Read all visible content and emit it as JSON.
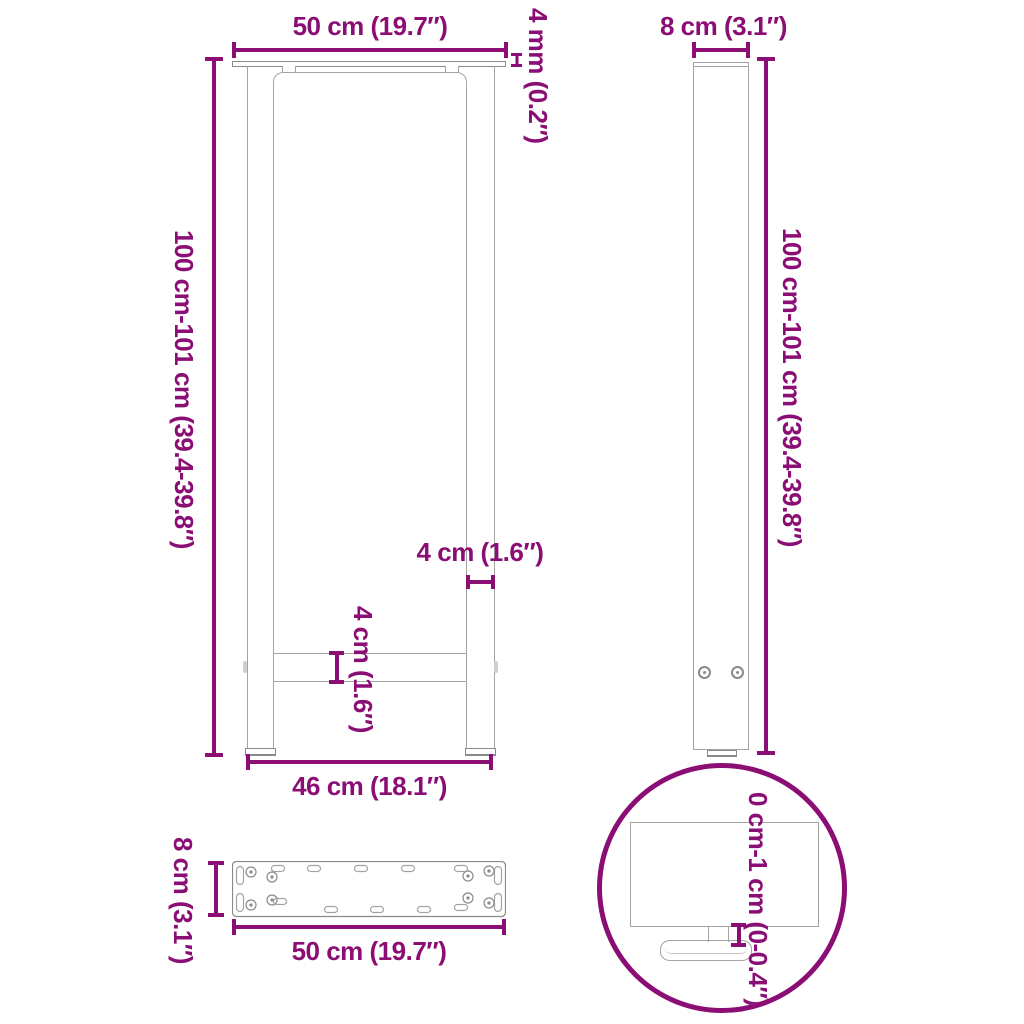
{
  "colors": {
    "accent": "#8A0E74",
    "line_gray": "#A3A3A3",
    "dark_gray": "#8A8A8A",
    "background": "#FFFFFF"
  },
  "front_view": {
    "top_width": "50 cm (19.7″)",
    "plate_thickness": "4 mm (0.2″)",
    "height": "100 cm-101 cm (39.4-39.8″)",
    "upright_width": "4 cm (1.6″)",
    "crossbar_height": "4 cm (1.6″)",
    "bottom_width": "46 cm (18.1″)"
  },
  "side_view": {
    "top_depth": "8 cm (3.1″)",
    "height": "100 cm-101 cm (39.4-39.8″)"
  },
  "plate_view": {
    "depth": "8 cm (3.1″)",
    "width": "50 cm (19.7″)"
  },
  "detail_view": {
    "adjustable_range": "0 cm-1 cm (0-0.4″)"
  }
}
